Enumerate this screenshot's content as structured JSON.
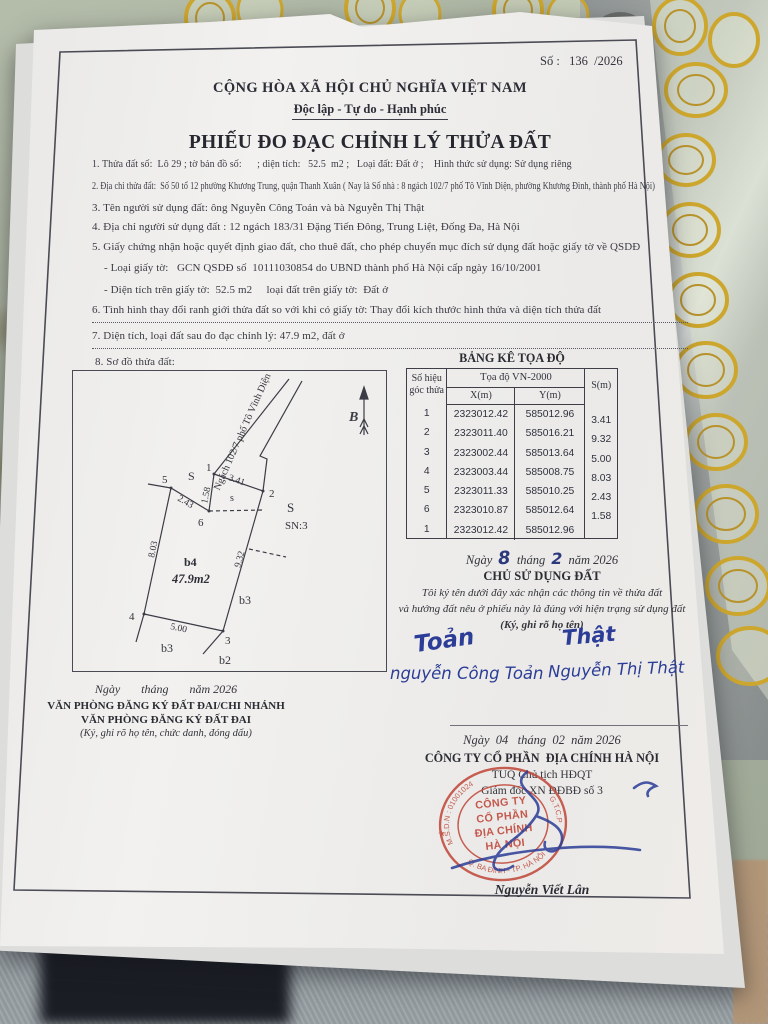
{
  "colors": {
    "paper": "#efeeec",
    "ink": "#33343c",
    "ink_blue": "#2b3d96",
    "stamp_red": "#bf4538",
    "gold_lace": "#cda62e",
    "fabric_green": "#a9b2a0",
    "metal_grey": "#a8adaa"
  },
  "meta": {
    "doc_no_line": "Số :   136  /2026"
  },
  "header": {
    "national": "CỘNG HÒA XÃ HỘI CHỦ NGHĨA VIỆT NAM",
    "motto": "Độc lập - Tự do - Hạnh phúc",
    "title": "PHIẾU ĐO ĐẠC CHỈNH LÝ THỬA ĐẤT"
  },
  "items": {
    "i1": "1. Thửa đất số:  Lô 29 ; tờ bản đồ số:      ; diện tích:   52.5  m2 ;   Loại đất: Đất ở ;    Hình thức sử dụng: Sử dụng riêng",
    "i2": "2. Địa chỉ thửa đất:  Số 50 tổ 12 phường Khương Trung, quận Thanh Xuân ( Nay là Số nhà : 8 ngách 102/7 phố Tô Vĩnh Diện, phường Khương Đình, thành phố Hà Nội)",
    "i3": "3. Tên người sử dụng đất: ông Nguyễn Công Toản và bà Nguyễn Thị Thật",
    "i4": "4. Địa chỉ người sử dụng đất : 12 ngách 183/31 Đặng Tiến Đông, Trung Liệt, Đống Đa, Hà Nội",
    "i5": "5. Giấy chứng nhận hoặc quyết định giao đất, cho thuê đất, cho phép chuyển mục đích sử dụng đất hoặc giấy tờ về QSDĐ",
    "i5a": "- Loại giấy tờ:   GCN QSDĐ số  10111030854 do UBND thành phố Hà Nội cấp ngày 16/10/2001",
    "i5b": "- Diện tích trên giấy tờ:  52.5 m2     loại đất trên giấy tờ:  Đất ở",
    "i6": "6. Tình hình thay đổi ranh giới thửa đất so với khi có giấy tờ: Thay đổi kích thước hình thửa và diện tích thửa đất",
    "i7": "7. Diện tích, loại đất sau đo đạc chỉnh lý: 47.9 m2, đất ở",
    "i8": "8. Sơ đồ thửa đất:"
  },
  "table": {
    "title": "BẢNG KÊ TỌA ĐỘ",
    "corner_header_1": "Số hiệu",
    "corner_header_2": "góc thửa",
    "coord_header": "Tọa độ VN-2000",
    "x_header": "X(m)",
    "y_header": "Y(m)",
    "s_header": "S(m)",
    "rows": [
      {
        "n": "1",
        "x": "2323012.42",
        "y": "585012.96"
      },
      {
        "n": "2",
        "x": "2323011.40",
        "y": "585016.21"
      },
      {
        "n": "3",
        "x": "2323002.44",
        "y": "585013.64"
      },
      {
        "n": "4",
        "x": "2323003.44",
        "y": "585008.75"
      },
      {
        "n": "5",
        "x": "2323011.33",
        "y": "585010.25"
      },
      {
        "n": "6",
        "x": "2323010.87",
        "y": "585012.64"
      },
      {
        "n": "1",
        "x": "2323012.42",
        "y": "585012.96"
      }
    ],
    "s_values": [
      "3.41",
      "9.32",
      "5.00",
      "8.03",
      "2.43",
      "1.58"
    ]
  },
  "diagram": {
    "street": "Ngách 102/7 phố Tô Vĩnh Diện",
    "north": "B",
    "parcel": "b4",
    "area": "47.9m2",
    "labels": {
      "s1": "S",
      "s2": "s",
      "s3": "S",
      "sn": "SN:3",
      "b3_right": "b3",
      "b3_bottom": "b3",
      "b2": "b2"
    },
    "vertices": [
      "1",
      "2",
      "3",
      "4",
      "5",
      "6"
    ],
    "lengths": {
      "e12": "3.41",
      "e23": "9.32",
      "e34": "5.00",
      "e45": "8.03",
      "e56": "2.43",
      "e61": "1.58"
    }
  },
  "owner": {
    "date_pre": "Ngày",
    "date_day": "8",
    "date_mid": "tháng",
    "date_month": "2",
    "date_post": "năm 2026",
    "heading": "CHỦ SỬ DỤNG ĐẤT",
    "note1": "Tôi ký tên dưới đây xác nhận các thông tin về thửa đất",
    "note2": "và hướng đất nêu ở phiếu này là đúng với hiện trạng sử dụng đất",
    "note3": "(Ký, ghi rõ họ tên)",
    "sig1_swash": "Toản",
    "sig1_name": "nguyễn Công Toản",
    "sig2_swash": "Thật",
    "sig2_name": "Nguyễn Thị Thật"
  },
  "registry": {
    "date_line": "Ngày       tháng       năm 2026",
    "line1": "VĂN PHÒNG ĐĂNG KÝ ĐẤT ĐAI/CHI NHÁNH",
    "line2": "VĂN PHÒNG ĐĂNG KÝ ĐẤT ĐAI",
    "note": "(Ký, ghi rõ họ tên, chức danh, đóng dấu)"
  },
  "company": {
    "date_line": "Ngày  04   tháng  02  năm 2026",
    "name": "CÔNG TY CỔ PHẦN  ĐỊA CHÍNH HÀ NỘI",
    "line2": "TUQ Chủ tịch HĐQT",
    "line3": "Giám đốc XN ĐĐBĐ số 3",
    "signer": "Nguyễn Viết Lân"
  },
  "stamp": {
    "ring_top": "M.S.D.N : 01001024",
    "ring_right": "G.T.C.P",
    "ring_bottom": "Q. BA ĐÌNH - TP. HÀ NỘI",
    "star": "★",
    "line1": "CÔNG TY",
    "line2": "CỔ PHẦN",
    "line3": "ĐỊA CHÍNH",
    "line4": "HÀ NỘI"
  }
}
